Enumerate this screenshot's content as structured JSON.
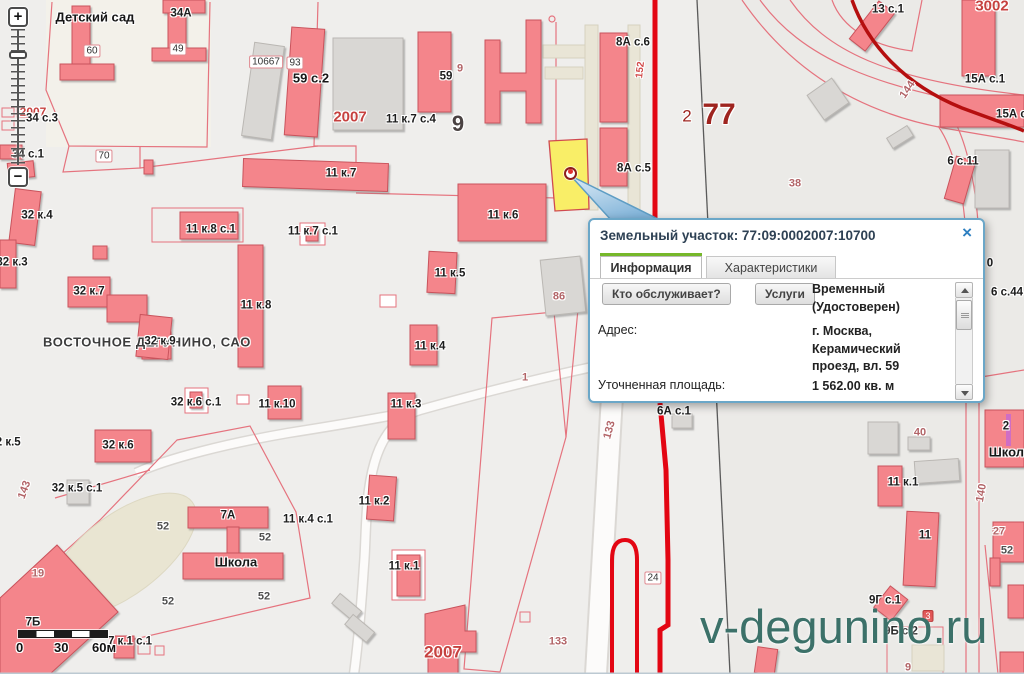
{
  "popup": {
    "title": "Земельный участок: 77:09:0002007:10700",
    "close_label": "×",
    "tabs": [
      {
        "label": "Информация",
        "active": true
      },
      {
        "label": "Характеристики",
        "active": false
      }
    ],
    "buttons": [
      {
        "label": "Кто обслуживает?"
      },
      {
        "label": "Услуги"
      }
    ],
    "fields": [
      {
        "label": "",
        "value": "Временный\n(Удостоверен)"
      },
      {
        "label": "Адрес:",
        "value": "г. Москва,\nКерамический\nпроезд, вл. 59"
      },
      {
        "label": "Уточненная площадь:",
        "value": "1 562.00 кв. м"
      }
    ]
  },
  "controls": {
    "zoom_in": "+",
    "zoom_out": "−"
  },
  "scale_bar": {
    "ticks": [
      "0",
      "30",
      "60м"
    ]
  },
  "watermark": "v-degunino.ru",
  "colors": {
    "popup_border_blue": "#6ba7c8",
    "tab_green": "#76b82a",
    "parcel_yellow": "#f9ee67",
    "building_pink": "#f4858b",
    "road_red": "#e30613",
    "watermark_teal": "#3c7169"
  },
  "map": {
    "labels": [
      {
        "t": "Детский сад",
        "x": 95,
        "y": 17,
        "c": "big"
      },
      {
        "t": "34А",
        "x": 181,
        "y": 14,
        "c": "std"
      },
      {
        "t": "60",
        "x": 92,
        "y": 51,
        "c": "plaque"
      },
      {
        "t": "49",
        "x": 178,
        "y": 49,
        "c": "plaque"
      },
      {
        "t": "10667",
        "x": 266,
        "y": 62,
        "c": "plaque"
      },
      {
        "t": "93",
        "x": 295,
        "y": 63,
        "c": "plaque"
      },
      {
        "t": "59 с.2",
        "x": 311,
        "y": 78,
        "c": "big"
      },
      {
        "t": "2007",
        "x": 350,
        "y": 117,
        "c": "red15"
      },
      {
        "t": "11 к.7 с.4",
        "x": 411,
        "y": 120,
        "c": "std"
      },
      {
        "t": "9",
        "x": 458,
        "y": 124,
        "c": "big-num"
      },
      {
        "t": "59",
        "x": 446,
        "y": 77,
        "c": "std"
      },
      {
        "t": "9",
        "x": 460,
        "y": 69,
        "c": "muted"
      },
      {
        "t": "2007",
        "x": 33,
        "y": 112,
        "c": "red12"
      },
      {
        "t": "34 с.3",
        "x": 42,
        "y": 119,
        "c": "std"
      },
      {
        "t": "34 с.1",
        "x": 28,
        "y": 155,
        "c": "std"
      },
      {
        "t": "70",
        "x": 104,
        "y": 156,
        "c": "plaque"
      },
      {
        "t": "11 к.7",
        "x": 341,
        "y": 174,
        "c": "std"
      },
      {
        "t": "11 к.6",
        "x": 503,
        "y": 216,
        "c": "std"
      },
      {
        "t": "8А с.6",
        "x": 633,
        "y": 43,
        "c": "std"
      },
      {
        "t": "152",
        "x": 641,
        "y": 70,
        "c": "red11",
        "r": -83
      },
      {
        "t": "2",
        "x": 687,
        "y": 116,
        "c": "dark-red-md"
      },
      {
        "t": "77",
        "x": 719,
        "y": 115,
        "c": "dark-red-big"
      },
      {
        "t": "13 с.1",
        "x": 888,
        "y": 10,
        "c": "std"
      },
      {
        "t": "3002",
        "x": 992,
        "y": 6,
        "c": "red15"
      },
      {
        "t": "15А с.1",
        "x": 985,
        "y": 80,
        "c": "std"
      },
      {
        "t": "15А с.",
        "x": 1013,
        "y": 115,
        "c": "std"
      },
      {
        "t": "144",
        "x": 908,
        "y": 90,
        "c": "muted",
        "r": -55
      },
      {
        "t": "6 с.11",
        "x": 963,
        "y": 162,
        "c": "std"
      },
      {
        "t": "8А с.5",
        "x": 634,
        "y": 169,
        "c": "std"
      },
      {
        "t": "38",
        "x": 795,
        "y": 184,
        "c": "muted"
      },
      {
        "t": "32 к.4",
        "x": 37,
        "y": 216,
        "c": "std"
      },
      {
        "t": "32 к.3",
        "x": 12,
        "y": 263,
        "c": "std"
      },
      {
        "t": "11 к.8 с.1",
        "x": 211,
        "y": 230,
        "c": "std"
      },
      {
        "t": "11 к.7 с.1",
        "x": 313,
        "y": 232,
        "c": "std"
      },
      {
        "t": "32 к.7",
        "x": 89,
        "y": 292,
        "c": "std"
      },
      {
        "t": "11 к.8",
        "x": 256,
        "y": 306,
        "c": "std"
      },
      {
        "t": "11 к.5",
        "x": 450,
        "y": 274,
        "c": "std"
      },
      {
        "t": "86",
        "x": 559,
        "y": 297,
        "c": "muted"
      },
      {
        "t": "ВОСТОЧНОЕ ДЕГУНИНО, САО",
        "x": 147,
        "y": 342,
        "c": "district"
      },
      {
        "t": "32 к.9",
        "x": 160,
        "y": 342,
        "c": "std"
      },
      {
        "t": "11 к.4",
        "x": 430,
        "y": 347,
        "c": "std"
      },
      {
        "t": "32 к.6 с.1",
        "x": 196,
        "y": 403,
        "c": "std"
      },
      {
        "t": "11 к.10",
        "x": 277,
        "y": 405,
        "c": "std"
      },
      {
        "t": "11 к.3",
        "x": 406,
        "y": 405,
        "c": "std"
      },
      {
        "t": "1",
        "x": 525,
        "y": 378,
        "c": "muted"
      },
      {
        "t": "133",
        "x": 610,
        "y": 430,
        "c": "muted",
        "r": -75
      },
      {
        "t": "6А с.1",
        "x": 674,
        "y": 412,
        "c": "std"
      },
      {
        "t": "32 к.6",
        "x": 118,
        "y": 446,
        "c": "std"
      },
      {
        "t": "143",
        "x": 25,
        "y": 490,
        "c": "muted",
        "r": -70
      },
      {
        "t": "32 к.5",
        "x": 5,
        "y": 443,
        "c": "std"
      },
      {
        "t": "32 к.5 с.1",
        "x": 77,
        "y": 489,
        "c": "std"
      },
      {
        "t": "7А",
        "x": 228,
        "y": 516,
        "c": "std"
      },
      {
        "t": "52",
        "x": 163,
        "y": 527,
        "c": "gray"
      },
      {
        "t": "52",
        "x": 265,
        "y": 538,
        "c": "gray"
      },
      {
        "t": "52",
        "x": 168,
        "y": 602,
        "c": "gray"
      },
      {
        "t": "52",
        "x": 264,
        "y": 597,
        "c": "gray"
      },
      {
        "t": "Школа",
        "x": 236,
        "y": 562,
        "c": "big"
      },
      {
        "t": "11 к.4 с.1",
        "x": 308,
        "y": 520,
        "c": "std"
      },
      {
        "t": "19",
        "x": 38,
        "y": 574,
        "c": "muted"
      },
      {
        "t": "7Б",
        "x": 33,
        "y": 623,
        "c": "std"
      },
      {
        "t": "7 к.1 с.1",
        "x": 130,
        "y": 642,
        "c": "std"
      },
      {
        "t": "11 к.2",
        "x": 374,
        "y": 502,
        "c": "std"
      },
      {
        "t": "11 к.1",
        "x": 404,
        "y": 567,
        "c": "std"
      },
      {
        "t": "2007",
        "x": 443,
        "y": 652,
        "c": "red16"
      },
      {
        "t": "133",
        "x": 558,
        "y": 642,
        "c": "muted"
      },
      {
        "t": "24",
        "x": 653,
        "y": 578,
        "c": "plaque"
      },
      {
        "t": "40",
        "x": 920,
        "y": 433,
        "c": "muted"
      },
      {
        "t": "11 к.1",
        "x": 903,
        "y": 483,
        "c": "std"
      },
      {
        "t": "11",
        "x": 925,
        "y": 536,
        "c": "std"
      },
      {
        "t": "9Г с.1",
        "x": 885,
        "y": 601,
        "c": "std"
      },
      {
        "t": "9Б с.2",
        "x": 901,
        "y": 632,
        "c": "std"
      },
      {
        "t": "3",
        "x": 928,
        "y": 616,
        "c": "badge"
      },
      {
        "t": "9",
        "x": 908,
        "y": 668,
        "c": "muted"
      },
      {
        "t": "2",
        "x": 1006,
        "y": 427,
        "c": "std"
      },
      {
        "t": "Школа",
        "x": 1010,
        "y": 452,
        "c": "big"
      },
      {
        "t": "140",
        "x": 982,
        "y": 493,
        "c": "muted",
        "r": -80
      },
      {
        "t": "27",
        "x": 999,
        "y": 532,
        "c": "muted"
      },
      {
        "t": "52",
        "x": 1007,
        "y": 551,
        "c": "gray"
      },
      {
        "t": "0",
        "x": 990,
        "y": 264,
        "c": "std"
      },
      {
        "t": "6 с.44",
        "x": 1007,
        "y": 293,
        "c": "std"
      }
    ]
  }
}
